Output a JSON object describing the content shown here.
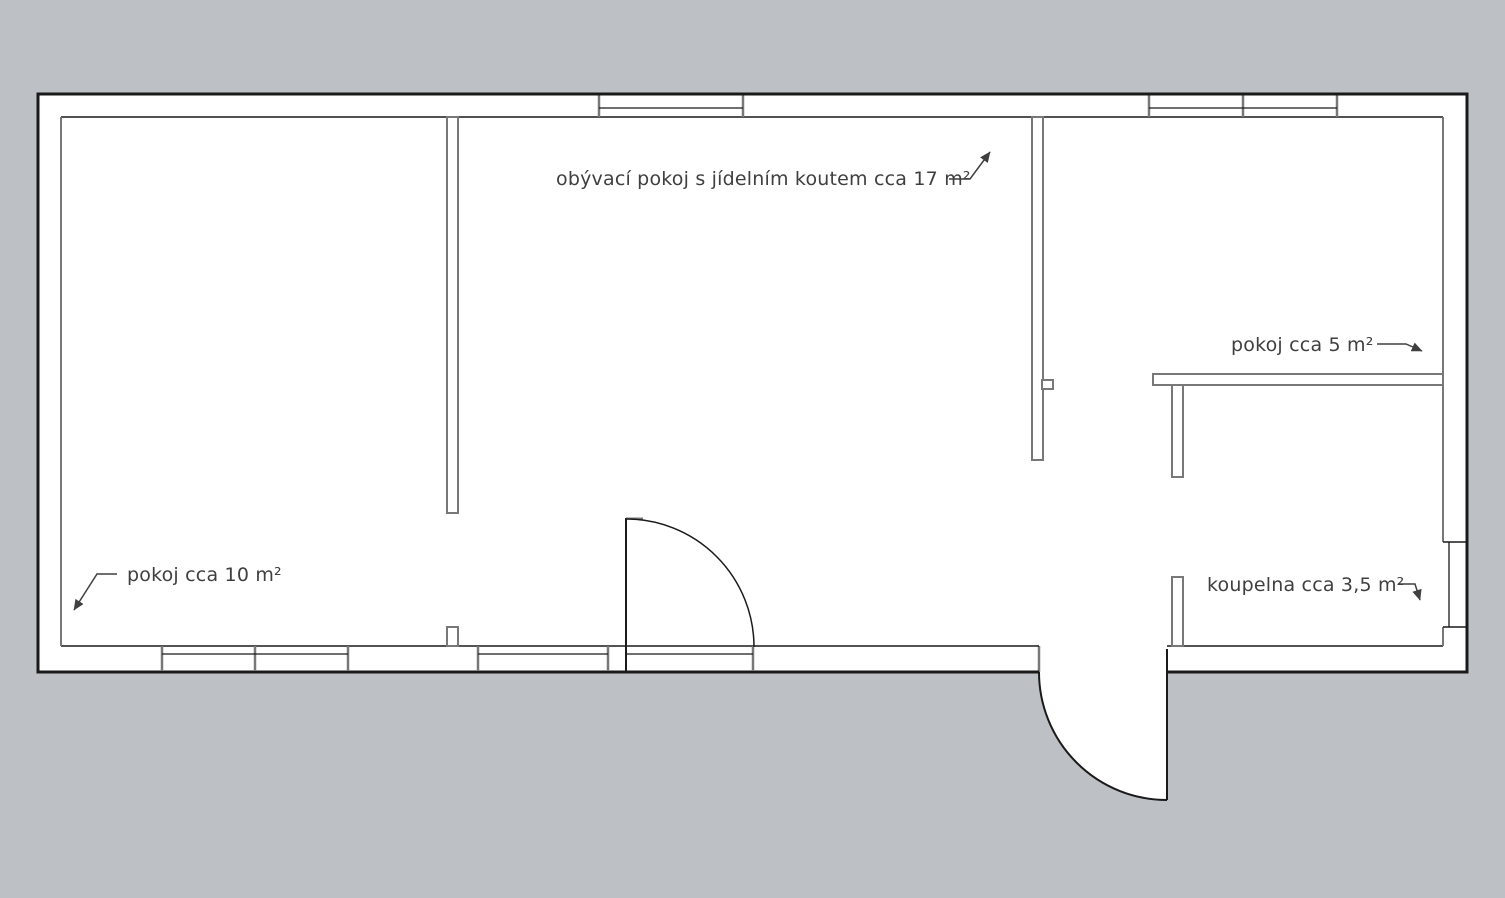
{
  "colors": {
    "background": "#bdc0c4",
    "floor": "#ffffff",
    "outline": "#1a1a1a",
    "partition": "#787878",
    "text": "#3f3f3f"
  },
  "plan": {
    "type": "apartment-floor-plan",
    "labels": {
      "living_room": "obývací pokoj s jídelním koutem cca 17 m²",
      "small_room": "pokoj cca 5 m²",
      "bedroom": "pokoj cca 10 m²",
      "bathroom": "koupelna cca 3,5 m²"
    }
  }
}
